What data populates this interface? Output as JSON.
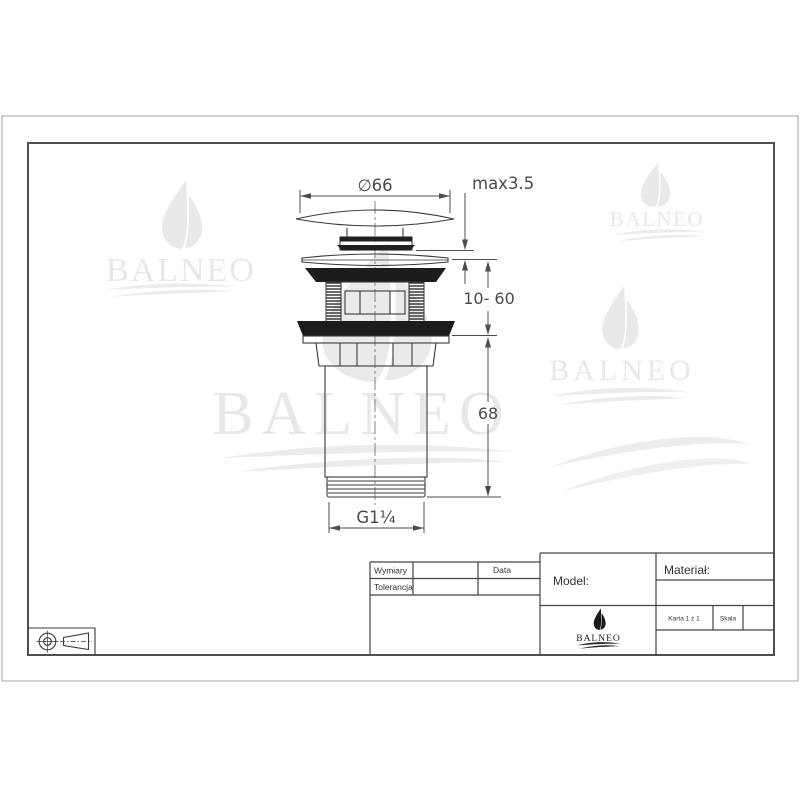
{
  "brand": {
    "name": "BALNEO"
  },
  "drawing": {
    "dimensions": {
      "cap_diameter": "∅66",
      "cap_gap_max": "max3.5",
      "clamp_range": "10- 60",
      "body_length": "68",
      "thread_size": "G1¼"
    }
  },
  "title_block": {
    "dims_label": "Wymiary",
    "tolerance_label": "Tolerancja",
    "date_label": "Data",
    "model_label": "Model:",
    "material_label": "Materiał:",
    "sheet_label": "Karta 1 z 1",
    "scale_label": "Skala",
    "logo_text": "BALNEO"
  },
  "colors": {
    "line": "#3a3a3a",
    "dimension": "#4a4a4a",
    "watermark": "#e8e8e8",
    "background": "#ffffff"
  }
}
